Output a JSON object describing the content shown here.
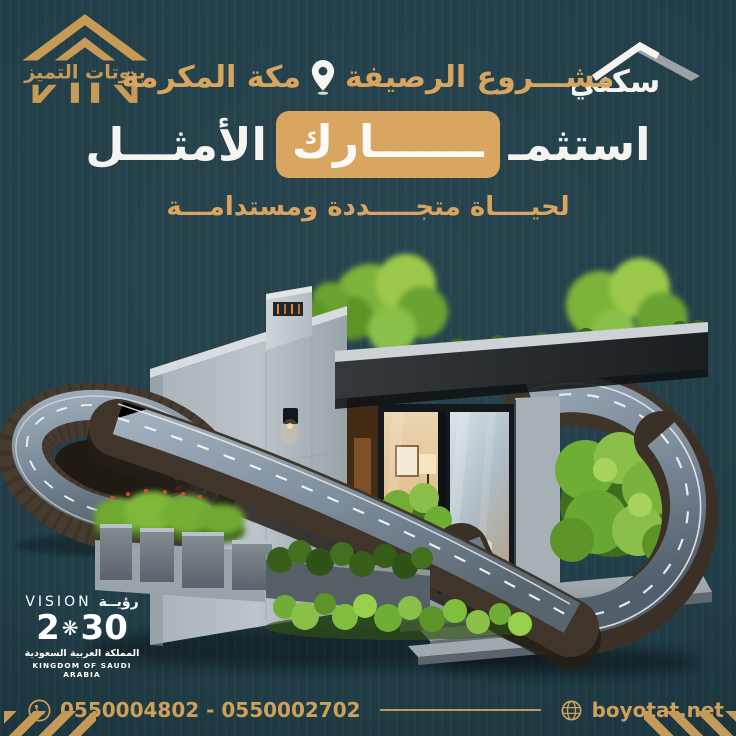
{
  "brand": {
    "name": "بيوتات التميز"
  },
  "partner": {
    "name": "سكني"
  },
  "header": {
    "project": "مشـــروع الرصيفة",
    "city": "مكة المكرمة",
    "headline_start": "استثمـ",
    "headline_highlight": "ـــــــارك",
    "headline_end": "الأمثـــل",
    "tagline": "لحيــــاة متجـــــددة ومستدامـــة"
  },
  "vision2030": {
    "label_en": "VISION",
    "label_ar": "رؤيــة",
    "year_prefix": "2",
    "emblem": "❋",
    "year_suffix": "30",
    "country_ar": "المملكة العربية السعودية",
    "country_en": "KINGDOM OF SAUDI ARABIA"
  },
  "contact": {
    "phones": "0550004802 - 0550002702",
    "website": "boyotat.net"
  },
  "colors": {
    "background": "#223f49",
    "gold": "#cfa05c",
    "gold_highlight": "#d9a661",
    "text_white": "#f3f2ee"
  }
}
